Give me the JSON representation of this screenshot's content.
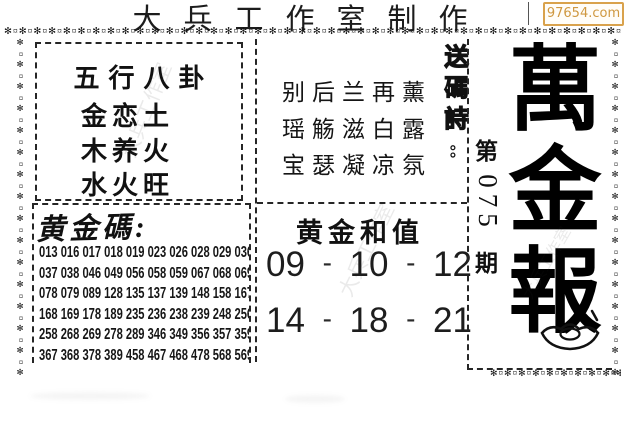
{
  "header": {
    "title": "大兵工作室制作",
    "site_badge": "97654.com"
  },
  "five_elements": {
    "heading": "五行八卦",
    "lines": [
      "金恋土",
      "木养火",
      "水火旺"
    ]
  },
  "send_code_poem": {
    "label": "送碼詩:",
    "lines": [
      "别后兰再薰",
      "瑶觞滋白露",
      "宝瑟凝凉氛"
    ]
  },
  "golden_codes": {
    "heading": "黄金碼:",
    "rows": [
      [
        "013",
        "016",
        "017",
        "018",
        "019",
        "023",
        "026",
        "028",
        "029",
        "036"
      ],
      [
        "037",
        "038",
        "046",
        "049",
        "056",
        "058",
        "059",
        "067",
        "068",
        "069"
      ],
      [
        "078",
        "079",
        "089",
        "128",
        "135",
        "137",
        "139",
        "148",
        "158",
        "167"
      ],
      [
        "168",
        "169",
        "178",
        "189",
        "235",
        "236",
        "238",
        "239",
        "248",
        "256"
      ],
      [
        "258",
        "268",
        "269",
        "278",
        "289",
        "346",
        "349",
        "356",
        "357",
        "359"
      ],
      [
        "367",
        "368",
        "378",
        "389",
        "458",
        "467",
        "468",
        "478",
        "568",
        "569"
      ]
    ]
  },
  "golden_sum": {
    "heading": "黄金和值",
    "separator": "-",
    "rows": [
      [
        "09",
        "10",
        "12"
      ],
      [
        "14",
        "18",
        "21"
      ]
    ]
  },
  "masthead": {
    "title_chars": [
      "萬",
      "金",
      "報"
    ],
    "issue_prefix": "第",
    "issue_number": "075",
    "issue_suffix": "期",
    "ingot_icon": "gold-ingot"
  },
  "decor": {
    "star_pattern": "✻¤",
    "watermark": "大兵工作室"
  },
  "colors": {
    "badge_orange": "#d9a24c",
    "ink": "#111111",
    "watermark_gray": "rgba(50,50,50,0.10)"
  }
}
